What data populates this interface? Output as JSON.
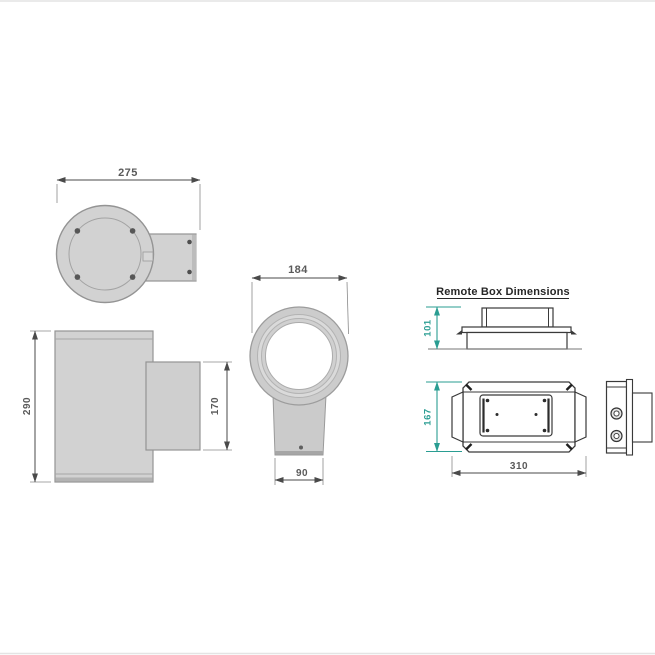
{
  "title": "Remote Box Dimensions",
  "dimensions": {
    "top_view_width": "275",
    "body_height": "290",
    "bracket_height": "170",
    "body_diameter": "184",
    "bracket_width": "90",
    "remote_box_height": "101",
    "remote_box_depth": "167",
    "remote_box_width": "310"
  },
  "colors": {
    "accent_teal": "#2a9d92",
    "dim_text_gray": "#5a5a5a",
    "drawing_line_gray": "#979797",
    "drawing_fill_gray": "#d2d2d2",
    "remote_box_line": "#3a3a3a"
  }
}
